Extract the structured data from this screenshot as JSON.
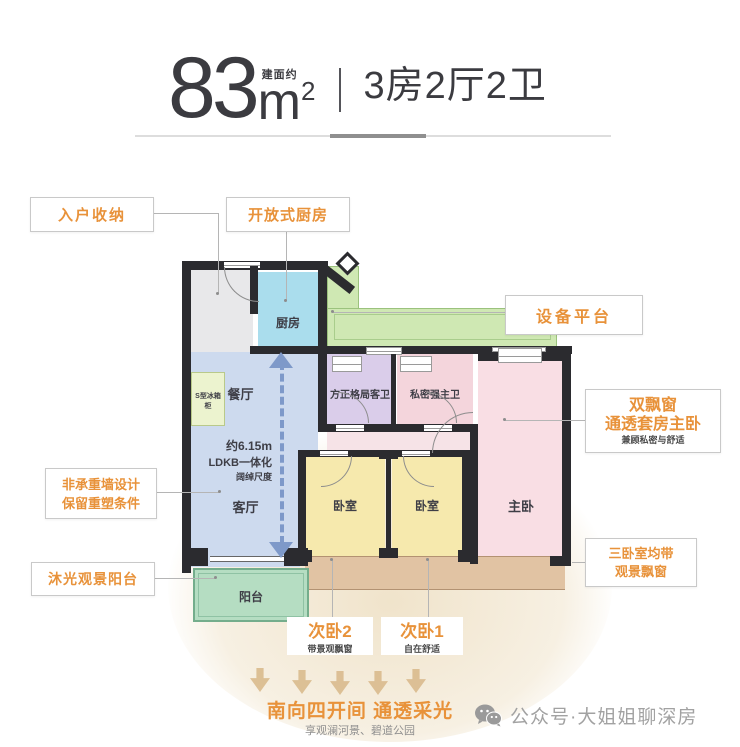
{
  "header": {
    "area_value": "83",
    "area_prefix": "建面约",
    "area_unit": "m",
    "area_sup": "2",
    "layout_type": "3房2厅2卫"
  },
  "callouts": {
    "entry_storage": "入户收纳",
    "open_kitchen": "开放式厨房",
    "equipment_platform": "设备平台",
    "master_suite_line1": "双飘窗",
    "master_suite_line2": "通透套房主卧",
    "master_suite_sub": "兼顾私密与舒适",
    "wall_design_line1": "非承重墙设计",
    "wall_design_line2": "保留重塑条件",
    "light_balcony": "沐光观景阳台",
    "bay_windows_line1": "三卧室均带",
    "bay_windows_line2": "观景飘窗",
    "bedroom2_title": "次卧2",
    "bedroom2_sub": "带景观飘窗",
    "bedroom1_title": "次卧1",
    "bedroom1_sub": "自在舒适"
  },
  "rooms": {
    "kitchen": "厨房",
    "dining": "餐厅",
    "living": "客厅",
    "balcony": "阳台",
    "bedroom_left": "卧室",
    "bedroom_right": "卧室",
    "master_bedroom": "主卧",
    "guest_bathroom": "方正格局客卫",
    "master_bathroom": "私密强主卫",
    "fridge_cabinet": "S型冰箱柜"
  },
  "annotations": {
    "dimension_line1": "约6.15m",
    "dimension_line2": "LDKB一体化",
    "dimension_line3": "阔绰尺度"
  },
  "footer": {
    "headline": "南向四开间 通透采光",
    "subline": "享观澜河景、碧道公园",
    "watermark": "公众号·大姐姐聊深房"
  },
  "colors": {
    "accent_orange": "#E8923A",
    "wall_black": "#2B2B2F",
    "arrow_blue": "#7E99C9",
    "glow_beige": "#E4CDA0",
    "kitchen_blue": "#AADDED",
    "ldk_blue": "#CDDAEE",
    "platform_green": "#CFE8B3",
    "guest_bath_purple": "#DACDEA",
    "master_bath_pink": "#F4D5DC",
    "master_bed_pink": "#F9DEE4",
    "bedroom_yellow": "#F6E9AD",
    "balcony_green": "#B5DDC2",
    "bay_tan": "#E1C3A3"
  }
}
